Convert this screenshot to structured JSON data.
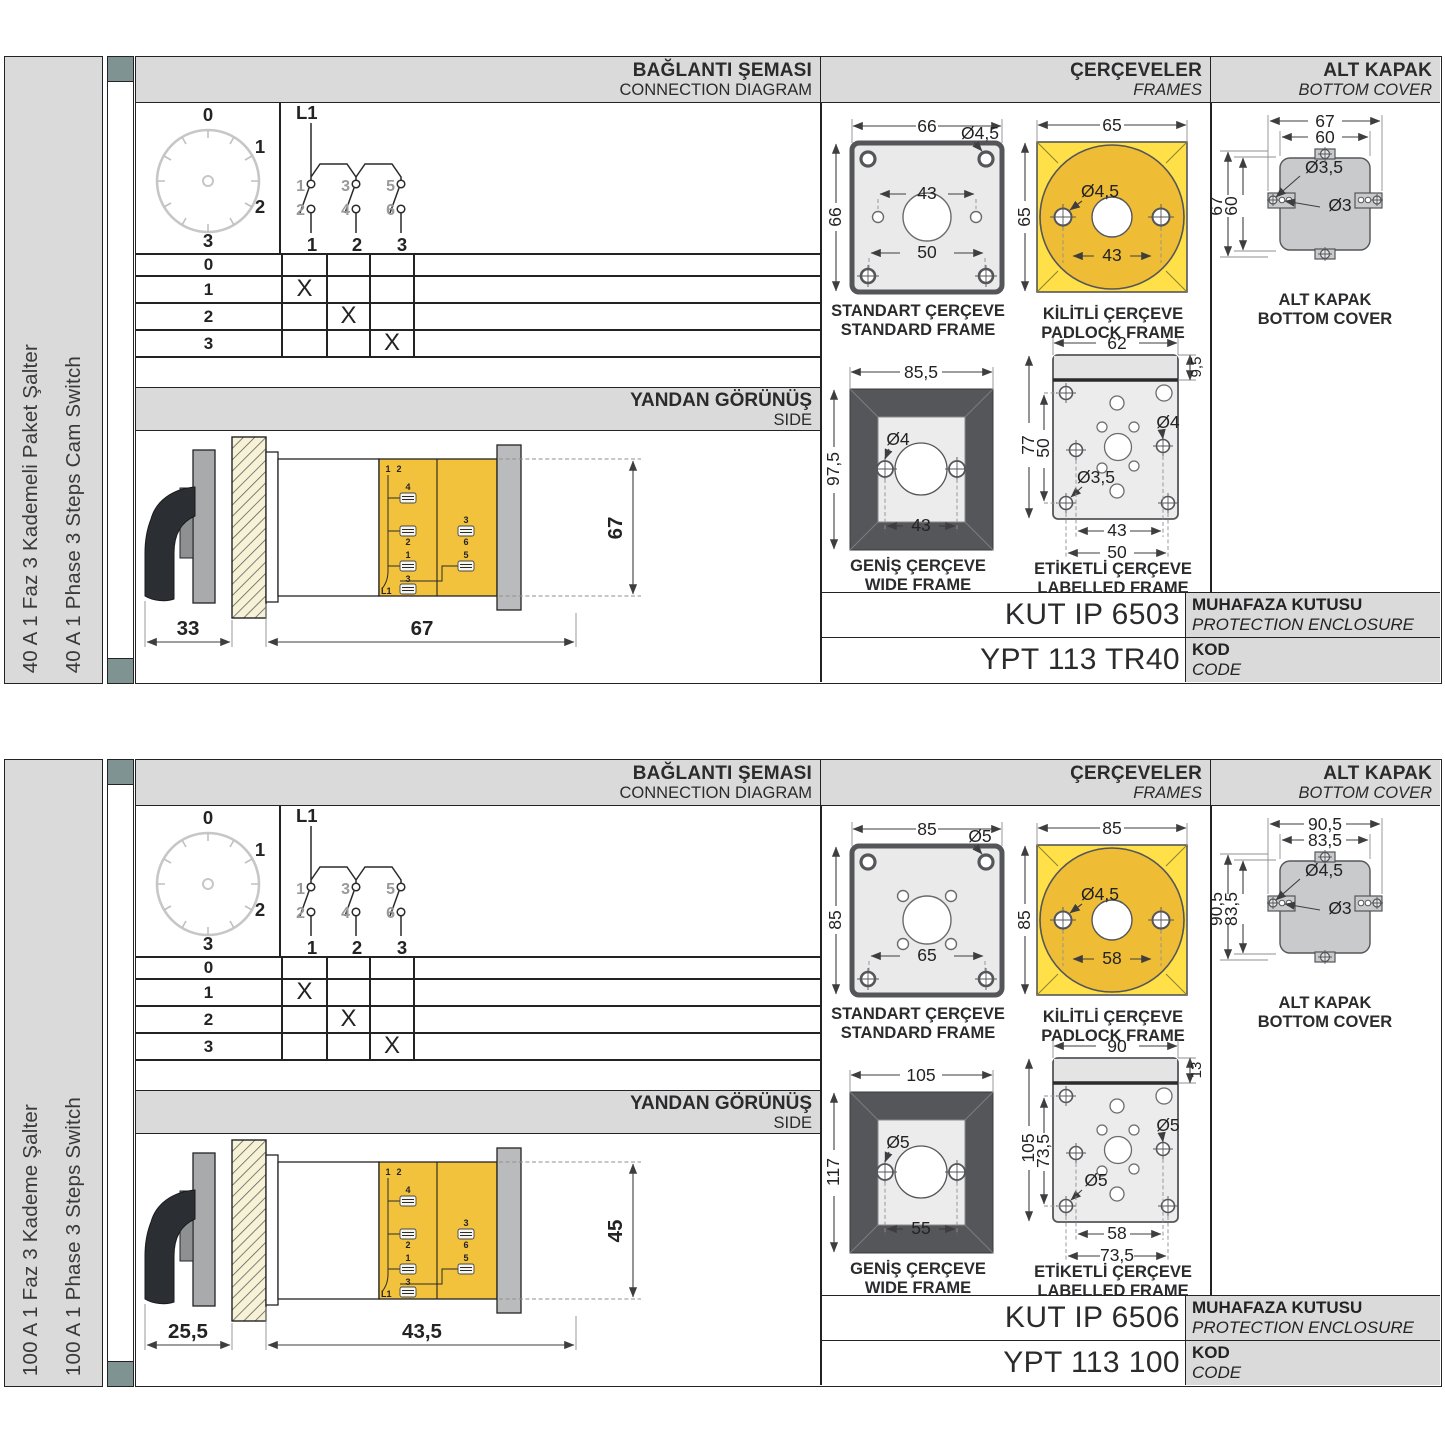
{
  "colors": {
    "panel_gray": "#d9dad9",
    "accent_square": "#7e9392",
    "frame_yellow": "#ffe049",
    "circle_amber": "#efbd35",
    "terminal_yellow": "#f2c23c",
    "drawing_dark": "#55565a",
    "cover_gray": "#c9cacc",
    "hatch_cream": "#f7f2d6",
    "line_black": "#232325",
    "muted_number_gray": "#97999b"
  },
  "sections": [
    {
      "sidebar": {
        "line1": "40 A 1 Faz 3 Kademeli Paket Şalter",
        "line2": "40 A 1 Phase 3 Steps Cam Switch"
      },
      "headers": {
        "connection": {
          "tr": "BAĞLANTI ŞEMASI",
          "en": "CONNECTION DIAGRAM"
        },
        "frames": {
          "tr": "ÇERÇEVELER",
          "en": "FRAMES"
        },
        "cover": {
          "tr": "ALT KAPAK",
          "en": "BOTTOM COVER"
        }
      },
      "dial": {
        "pos0": "0",
        "pos1": "1",
        "pos2": "2",
        "pos3": "3"
      },
      "circuit": {
        "phase": "L1",
        "t1": "1",
        "t2": "2",
        "t3": "3",
        "t4": "4",
        "t5": "5",
        "t6": "6",
        "o1": "1",
        "o2": "2",
        "o3": "3"
      },
      "switch_table": {
        "r0": {
          "label": "0",
          "c1": "",
          "c2": "",
          "c3": ""
        },
        "r1": {
          "label": "1",
          "c1": "X",
          "c2": "",
          "c3": ""
        },
        "r2": {
          "label": "2",
          "c1": "",
          "c2": "X",
          "c3": ""
        },
        "r3": {
          "label": "3",
          "c1": "",
          "c2": "",
          "c3": "X"
        }
      },
      "side_view": {
        "tr": "YANDAN GÖRÜNÜŞ",
        "en": "SIDE",
        "dim_front": "33",
        "dim_depth": "67",
        "dim_height": "67",
        "terminals": {
          "top_a": "1",
          "top_b": "2",
          "m4": "4",
          "m2": "2",
          "r3": "3",
          "r6": "6",
          "b1": "1",
          "b3": "3",
          "b5": "5",
          "phase": "L1"
        }
      },
      "frames": {
        "standard": {
          "cap_tr": "STANDART ÇERÇEVE",
          "cap_en": "STANDARD FRAME",
          "d_width": "66",
          "d_hole": "Ø4,5",
          "d_mid": "43",
          "d_low": "50",
          "d_height": "66"
        },
        "padlock": {
          "cap_tr": "KİLİTLİ ÇERÇEVE",
          "cap_en": "PADLOCK FRAME",
          "d_width": "65",
          "d_hole": "Ø4,5",
          "d_mid": "43",
          "d_height": "65"
        },
        "wide": {
          "cap_tr": "GENİŞ ÇERÇEVE",
          "cap_en": "WIDE FRAME",
          "d_width": "85,5",
          "d_hole": "Ø4",
          "d_mid": "43",
          "d_height": "97,5"
        },
        "labelled": {
          "cap_tr": "ETİKETLİ ÇERÇEVE",
          "cap_en": "LABELLED FRAME",
          "d_width": "62",
          "d_strip": "9,5",
          "d_height": "77",
          "d_inner_h": "50",
          "d_hole_big": "Ø4",
          "d_hole_small": "Ø3,5",
          "d_b1": "43",
          "d_b2": "50"
        }
      },
      "cover": {
        "cap_tr": "ALT KAPAK",
        "cap_en": "BOTTOM COVER",
        "d_w1": "67",
        "d_w2": "60",
        "d_h1": "67",
        "d_h2": "60",
        "d_hole1": "Ø3,5",
        "d_hole2": "Ø3"
      },
      "codes": {
        "enclosure": "KUT IP 6503",
        "enclosure_tr": "MUHAFAZA KUTUSU",
        "enclosure_en": "PROTECTION ENCLOSURE",
        "code": "YPT 113 TR40",
        "code_tr": "KOD",
        "code_en": "CODE"
      }
    },
    {
      "sidebar": {
        "line1": "100 A 1 Faz 3 Kademe Şalter",
        "line2": "100 A 1 Phase 3 Steps Switch"
      },
      "headers": {
        "connection": {
          "tr": "BAĞLANTI ŞEMASI",
          "en": "CONNECTION DIAGRAM"
        },
        "frames": {
          "tr": "ÇERÇEVELER",
          "en": "FRAMES"
        },
        "cover": {
          "tr": "ALT KAPAK",
          "en": "BOTTOM COVER"
        }
      },
      "dial": {
        "pos0": "0",
        "pos1": "1",
        "pos2": "2",
        "pos3": "3"
      },
      "circuit": {
        "phase": "L1",
        "t1": "1",
        "t2": "2",
        "t3": "3",
        "t4": "4",
        "t5": "5",
        "t6": "6",
        "o1": "1",
        "o2": "2",
        "o3": "3"
      },
      "switch_table": {
        "r0": {
          "label": "0",
          "c1": "",
          "c2": "",
          "c3": ""
        },
        "r1": {
          "label": "1",
          "c1": "X",
          "c2": "",
          "c3": ""
        },
        "r2": {
          "label": "2",
          "c1": "",
          "c2": "X",
          "c3": ""
        },
        "r3": {
          "label": "3",
          "c1": "",
          "c2": "",
          "c3": "X"
        }
      },
      "side_view": {
        "tr": "YANDAN GÖRÜNÜŞ",
        "en": "SIDE",
        "dim_front": "25,5",
        "dim_depth": "43,5",
        "dim_height": "45",
        "terminals": {
          "top_a": "1",
          "top_b": "2",
          "m4": "4",
          "m2": "2",
          "r3": "3",
          "r6": "6",
          "b1": "1",
          "b3": "3",
          "b5": "5",
          "phase": "L1"
        }
      },
      "frames": {
        "standard": {
          "cap_tr": "STANDART ÇERÇEVE",
          "cap_en": "STANDARD FRAME",
          "d_width": "85",
          "d_hole": "Ø5",
          "d_low": "65",
          "d_height": "85"
        },
        "padlock": {
          "cap_tr": "KİLİTLİ ÇERÇEVE",
          "cap_en": "PADLOCK FRAME",
          "d_width": "85",
          "d_hole": "Ø4,5",
          "d_mid": "58",
          "d_height": "85"
        },
        "wide": {
          "cap_tr": "GENİŞ ÇERÇEVE",
          "cap_en": "WIDE FRAME",
          "d_width": "105",
          "d_hole": "Ø5",
          "d_mid": "55",
          "d_height": "117"
        },
        "labelled": {
          "cap_tr": "ETİKETLİ ÇERÇEVE",
          "cap_en": "LABELLED FRAME",
          "d_width": "90",
          "d_strip": "13",
          "d_height": "105",
          "d_inner_h": "73,5",
          "d_hole_big": "Ø5",
          "d_hole_small": "Ø5",
          "d_b1": "58",
          "d_b2": "73,5"
        }
      },
      "cover": {
        "cap_tr": "ALT KAPAK",
        "cap_en": "BOTTOM COVER",
        "d_w1": "90,5",
        "d_w2": "83,5",
        "d_h1": "90,5",
        "d_h2": "83,5",
        "d_hole1": "Ø4,5",
        "d_hole2": "Ø3"
      },
      "codes": {
        "enclosure": "KUT IP 6506",
        "enclosure_tr": "MUHAFAZA KUTUSU",
        "enclosure_en": "PROTECTION ENCLOSURE",
        "code": "YPT 113 100",
        "code_tr": "KOD",
        "code_en": "CODE"
      }
    }
  ]
}
